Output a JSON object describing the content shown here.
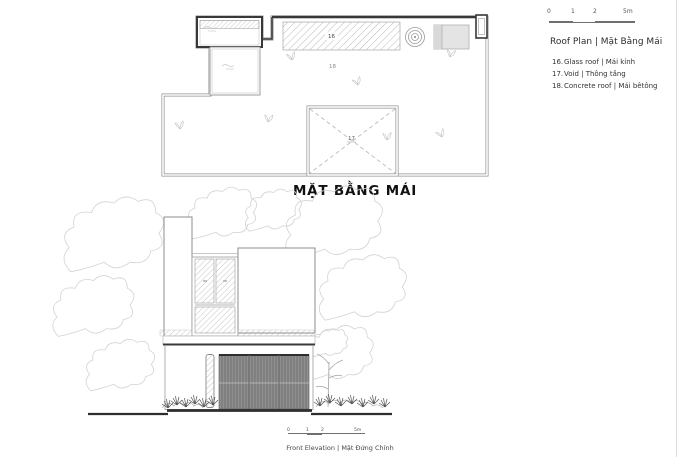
{
  "sheet": {
    "plan_title": "MẶT BẰNG MÁI",
    "elevation_caption": "Front Elevation | Mặt Đứng Chính"
  },
  "legend": {
    "heading": "Roof Plan | Mặt Bằng Mái",
    "items": [
      {
        "num": "16.",
        "label": "Glass roof | Mái kính"
      },
      {
        "num": "17.",
        "label": "Void | Thông tầng"
      },
      {
        "num": "18.",
        "label": "Concrete roof | Mái bêtông"
      }
    ]
  },
  "plan_labels": {
    "glass": "16",
    "void": "17",
    "concrete": "18"
  },
  "scalebar_top": {
    "t0": "0",
    "t1": "1",
    "t2": "2",
    "t5": "5m"
  },
  "scalebar_bottom": {
    "t0": "0",
    "t1": "1",
    "t2": "2",
    "t5": "5m"
  },
  "colors": {
    "line_dark": "#383838",
    "line_gray": "#8f8f8f",
    "hatch": "#9a9a9a",
    "tree_outline": "#d3d3d3",
    "gate_fill": "#8f8f8f",
    "equipment_fill": "#e4e4e4",
    "text": "#333333"
  }
}
